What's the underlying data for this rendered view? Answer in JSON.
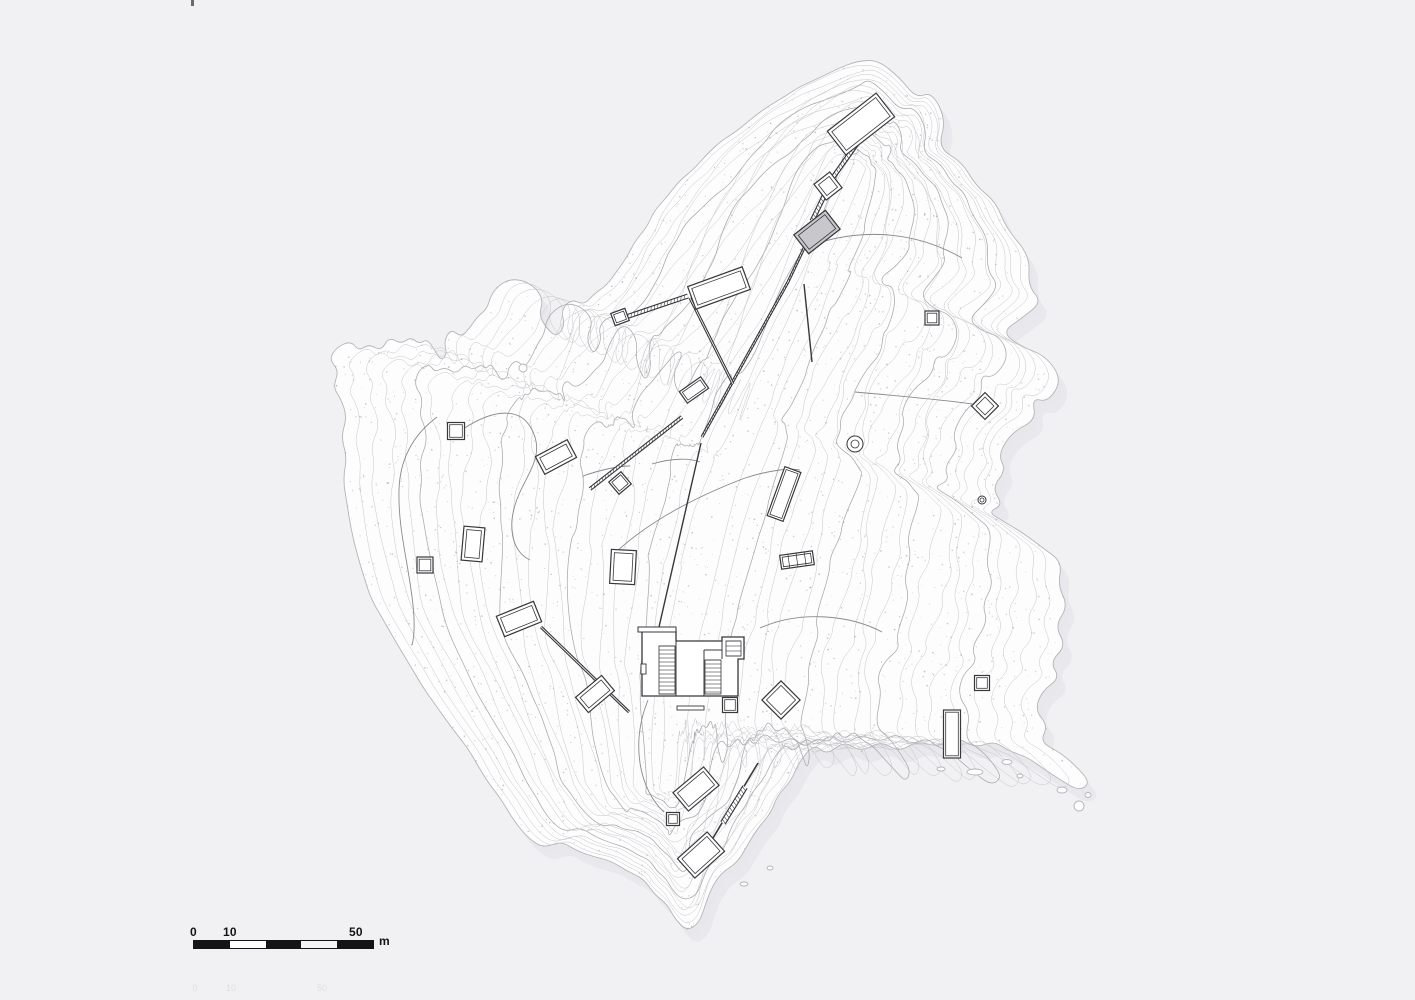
{
  "scale_bar": {
    "labels": [
      "0",
      "10",
      "50"
    ],
    "unit": "m",
    "segment_colors": [
      "#141414",
      "#ffffff",
      "#141414",
      "#f4f4f5",
      "#141414"
    ]
  },
  "ghost_labels": [
    {
      "text": "0",
      "x": 195,
      "y": 991
    },
    {
      "text": "10",
      "x": 231,
      "y": 991
    },
    {
      "text": "50",
      "x": 322,
      "y": 991
    }
  ],
  "top_mark": {
    "x": 191,
    "y": 0,
    "w": 3,
    "h": 6
  },
  "colors": {
    "background": "#f1f1f4",
    "island_fill": "#fdfdfe",
    "island_edge": "#b5b5b9",
    "shadow": "#e7e7eb",
    "contour": "#c6c6ca",
    "contour_index": "#a9a9ad",
    "stipple": "#98989c",
    "path": "#8a8a8e",
    "structure": "#38383c"
  },
  "island": {
    "contour_count": 22,
    "outline": [
      [
        878,
        60
      ],
      [
        900,
        78
      ],
      [
        916,
        98
      ],
      [
        932,
        92
      ],
      [
        946,
        120
      ],
      [
        938,
        148
      ],
      [
        962,
        162
      ],
      [
        976,
        186
      ],
      [
        996,
        202
      ],
      [
        1006,
        228
      ],
      [
        1030,
        256
      ],
      [
        1028,
        286
      ],
      [
        1042,
        302
      ],
      [
        1022,
        318
      ],
      [
        1002,
        332
      ],
      [
        1020,
        346
      ],
      [
        1046,
        356
      ],
      [
        1062,
        380
      ],
      [
        1048,
        402
      ],
      [
        1032,
        398
      ],
      [
        1036,
        420
      ],
      [
        1012,
        432
      ],
      [
        998,
        455
      ],
      [
        1006,
        470
      ],
      [
        992,
        488
      ],
      [
        1003,
        505
      ],
      [
        988,
        512
      ],
      [
        1003,
        521
      ],
      [
        1023,
        533
      ],
      [
        1043,
        548
      ],
      [
        1062,
        562
      ],
      [
        1058,
        586
      ],
      [
        1068,
        606
      ],
      [
        1055,
        626
      ],
      [
        1066,
        646
      ],
      [
        1050,
        662
      ],
      [
        1060,
        678
      ],
      [
        1042,
        691
      ],
      [
        1035,
        710
      ],
      [
        1048,
        726
      ],
      [
        1040,
        742
      ],
      [
        1061,
        753
      ],
      [
        1079,
        769
      ],
      [
        1090,
        783
      ],
      [
        1079,
        791
      ],
      [
        1059,
        779
      ],
      [
        1044,
        769
      ],
      [
        1027,
        757
      ],
      [
        1009,
        751
      ],
      [
        994,
        741
      ],
      [
        975,
        748
      ],
      [
        957,
        737
      ],
      [
        939,
        747
      ],
      [
        917,
        741
      ],
      [
        899,
        752
      ],
      [
        881,
        741
      ],
      [
        861,
        752
      ],
      [
        844,
        741
      ],
      [
        827,
        755
      ],
      [
        814,
        744
      ],
      [
        799,
        762
      ],
      [
        791,
        781
      ],
      [
        777,
        796
      ],
      [
        771,
        813
      ],
      [
        757,
        829
      ],
      [
        747,
        846
      ],
      [
        737,
        863
      ],
      [
        721,
        873
      ],
      [
        711,
        889
      ],
      [
        705,
        906
      ],
      [
        699,
        923
      ],
      [
        687,
        931
      ],
      [
        675,
        919
      ],
      [
        667,
        904
      ],
      [
        654,
        894
      ],
      [
        644,
        879
      ],
      [
        627,
        871
      ],
      [
        611,
        861
      ],
      [
        595,
        857
      ],
      [
        577,
        851
      ],
      [
        561,
        841
      ],
      [
        544,
        848
      ],
      [
        529,
        839
      ],
      [
        514,
        821
      ],
      [
        501,
        799
      ],
      [
        487,
        781
      ],
      [
        477,
        764
      ],
      [
        467,
        747
      ],
      [
        451,
        727
      ],
      [
        437,
        707
      ],
      [
        424,
        689
      ],
      [
        411,
        667
      ],
      [
        397,
        644
      ],
      [
        384,
        621
      ],
      [
        371,
        599
      ],
      [
        364,
        577
      ],
      [
        357,
        554
      ],
      [
        351,
        529
      ],
      [
        347,
        504
      ],
      [
        343,
        479
      ],
      [
        347,
        457
      ],
      [
        341,
        437
      ],
      [
        347,
        417
      ],
      [
        341,
        399
      ],
      [
        333,
        387
      ],
      [
        339,
        371
      ],
      [
        329,
        359
      ],
      [
        337,
        347
      ],
      [
        351,
        341
      ],
      [
        359,
        351
      ],
      [
        369,
        344
      ],
      [
        381,
        351
      ],
      [
        389,
        337
      ],
      [
        401,
        344
      ],
      [
        411,
        337
      ],
      [
        419,
        344
      ],
      [
        427,
        339
      ],
      [
        434,
        349
      ],
      [
        441,
        361
      ],
      [
        447,
        354
      ],
      [
        444,
        341
      ],
      [
        451,
        329
      ],
      [
        461,
        337
      ],
      [
        469,
        329
      ],
      [
        477,
        317
      ],
      [
        487,
        309
      ],
      [
        491,
        295
      ],
      [
        499,
        285
      ],
      [
        511,
        279
      ],
      [
        525,
        281
      ],
      [
        537,
        289
      ],
      [
        543,
        301
      ],
      [
        539,
        315
      ],
      [
        547,
        329
      ],
      [
        557,
        337
      ],
      [
        565,
        325
      ],
      [
        561,
        311
      ],
      [
        571,
        299
      ],
      [
        584,
        305
      ],
      [
        594,
        294
      ],
      [
        607,
        285
      ],
      [
        617,
        271
      ],
      [
        627,
        257
      ],
      [
        635,
        241
      ],
      [
        647,
        227
      ],
      [
        654,
        211
      ],
      [
        667,
        197
      ],
      [
        679,
        181
      ],
      [
        694,
        169
      ],
      [
        707,
        154
      ],
      [
        721,
        141
      ],
      [
        737,
        131
      ],
      [
        751,
        119
      ],
      [
        767,
        107
      ],
      [
        784,
        97
      ],
      [
        799,
        87
      ],
      [
        817,
        79
      ],
      [
        837,
        69
      ],
      [
        857,
        61
      ]
    ],
    "spine": [
      [
        858,
        165
      ],
      [
        826,
        245
      ],
      [
        782,
        345
      ],
      [
        730,
        460
      ],
      [
        696,
        570
      ],
      [
        676,
        680
      ],
      [
        668,
        790
      ]
    ],
    "islets": [
      {
        "name": "islet-ring",
        "cx": 523,
        "cy": 368,
        "rx": 4,
        "ry": 4
      },
      {
        "name": "islet",
        "cx": 975,
        "cy": 772,
        "rx": 8,
        "ry": 3
      },
      {
        "name": "islet",
        "cx": 1007,
        "cy": 762,
        "rx": 5,
        "ry": 2.5
      },
      {
        "name": "islet",
        "cx": 941,
        "cy": 769,
        "rx": 4,
        "ry": 2
      },
      {
        "name": "islet",
        "cx": 1020,
        "cy": 776,
        "rx": 3,
        "ry": 2
      },
      {
        "name": "islet",
        "cx": 1062,
        "cy": 790,
        "rx": 5,
        "ry": 3
      },
      {
        "name": "islet",
        "cx": 1079,
        "cy": 806,
        "rx": 5,
        "ry": 5
      },
      {
        "name": "islet",
        "cx": 1088,
        "cy": 795,
        "rx": 3,
        "ry": 2.5
      },
      {
        "name": "islet",
        "cx": 744,
        "cy": 884,
        "rx": 4,
        "ry": 2
      },
      {
        "name": "islet",
        "cx": 770,
        "cy": 868,
        "rx": 3,
        "ry": 2
      }
    ]
  },
  "structures": {
    "rects": [
      {
        "name": "north-jetty-head",
        "cx": 861,
        "cy": 124,
        "w": 62,
        "h": 30,
        "rot": -38
      },
      {
        "name": "north-wall-square",
        "cx": 828,
        "cy": 186,
        "w": 20,
        "h": 20,
        "rot": -38
      },
      {
        "name": "gray-roof-structure",
        "cx": 817,
        "cy": 232,
        "w": 40,
        "h": 24,
        "rot": -38,
        "fill": "#c8c8cc"
      },
      {
        "name": "upper-hall",
        "cx": 719,
        "cy": 288,
        "w": 58,
        "h": 24,
        "rot": -20
      },
      {
        "name": "l-wall-head",
        "cx": 620,
        "cy": 317,
        "w": 15,
        "h": 13,
        "rot": -20
      },
      {
        "name": "small-rect-a",
        "cx": 694,
        "cy": 390,
        "w": 26,
        "h": 14,
        "rot": -35
      },
      {
        "name": "rect-b",
        "cx": 556,
        "cy": 457,
        "w": 36,
        "h": 20,
        "rot": -28
      },
      {
        "name": "square-a",
        "cx": 456,
        "cy": 431,
        "w": 17,
        "h": 17,
        "rot": 0
      },
      {
        "name": "square-b",
        "cx": 425,
        "cy": 565,
        "w": 16,
        "h": 16,
        "rot": 0
      },
      {
        "name": "rect-c",
        "cx": 473,
        "cy": 544,
        "w": 21,
        "h": 34,
        "rot": 5
      },
      {
        "name": "rect-d",
        "cx": 519,
        "cy": 619,
        "w": 40,
        "h": 22,
        "rot": -22
      },
      {
        "name": "rect-e",
        "cx": 595,
        "cy": 694,
        "w": 34,
        "h": 20,
        "rot": -40
      },
      {
        "name": "rect-f",
        "cx": 623,
        "cy": 567,
        "w": 25,
        "h": 34,
        "rot": 3
      },
      {
        "name": "wall-node-square",
        "cx": 620,
        "cy": 483,
        "w": 16,
        "h": 16,
        "rot": -40
      },
      {
        "name": "rect-g",
        "cx": 696,
        "cy": 789,
        "w": 40,
        "h": 24,
        "rot": -40
      },
      {
        "name": "small-square-c",
        "cx": 673,
        "cy": 819,
        "w": 13,
        "h": 13,
        "rot": 0
      },
      {
        "name": "south-jetty-head",
        "cx": 701,
        "cy": 855,
        "w": 40,
        "h": 26,
        "rot": -42
      },
      {
        "name": "square-d",
        "cx": 730,
        "cy": 705,
        "w": 15,
        "h": 15,
        "rot": 0
      },
      {
        "name": "diamond-b",
        "cx": 781,
        "cy": 700,
        "w": 27,
        "h": 27,
        "rot": 45
      },
      {
        "name": "narrow-rect",
        "cx": 784,
        "cy": 494,
        "w": 17,
        "h": 52,
        "rot": 20
      },
      {
        "name": "tick-structure",
        "cx": 797,
        "cy": 560,
        "w": 33,
        "h": 14,
        "rot": -8,
        "ticks": 3
      },
      {
        "name": "square-e",
        "cx": 932,
        "cy": 318,
        "w": 14,
        "h": 14,
        "rot": 0
      },
      {
        "name": "diamond-a",
        "cx": 985,
        "cy": 406,
        "w": 19,
        "h": 19,
        "rot": 45
      },
      {
        "name": "square-f",
        "cx": 982,
        "cy": 683,
        "w": 15,
        "h": 15,
        "rot": 0
      },
      {
        "name": "rect-i",
        "cx": 952,
        "cy": 734,
        "w": 17,
        "h": 48,
        "rot": 0
      }
    ],
    "circles": [
      {
        "name": "well-circle",
        "cx": 855,
        "cy": 444,
        "r": 8,
        "r2": 4
      },
      {
        "name": "small-circle",
        "cx": 982,
        "cy": 500,
        "r": 4,
        "r2": 2
      }
    ],
    "walls": [
      {
        "name": "north-jetty-wall",
        "pts": [
          [
            861,
            138
          ],
          [
            829,
            183
          ]
        ],
        "w": 5,
        "double": true,
        "hatch": true
      },
      {
        "name": "north-wall-upper",
        "pts": [
          [
            826,
            192
          ],
          [
            812,
            221
          ]
        ],
        "w": 5,
        "double": true,
        "hatch": true
      },
      {
        "name": "north-wall-long",
        "pts": [
          [
            805,
            246
          ],
          [
            788,
            282
          ],
          [
            702,
            437
          ]
        ],
        "w": 3,
        "double": true,
        "hatch": true
      },
      {
        "name": "north-wall-lower",
        "pts": [
          [
            701,
            443
          ],
          [
            659,
            627
          ]
        ],
        "w": 1.4
      },
      {
        "name": "l-wall-top",
        "pts": [
          [
            626,
            317
          ],
          [
            688,
            296
          ]
        ],
        "w": 5,
        "double": true,
        "hatch": true
      },
      {
        "name": "l-wall-side",
        "pts": [
          [
            690,
            298
          ],
          [
            733,
            384
          ]
        ],
        "w": 3,
        "double": true
      },
      {
        "name": "spur-line",
        "pts": [
          [
            804,
            284
          ],
          [
            812,
            362
          ]
        ],
        "w": 1.4
      },
      {
        "name": "central-terrace-wall",
        "pts": [
          [
            590,
            489
          ],
          [
            682,
            417
          ]
        ],
        "w": 4,
        "double": true,
        "hatch": true
      },
      {
        "name": "sw-terrace-wall",
        "pts": [
          [
            541,
            627
          ],
          [
            629,
            712
          ]
        ],
        "w": 3,
        "double": true
      },
      {
        "name": "south-jetty-wall",
        "pts": [
          [
            758,
            763
          ],
          [
            707,
            848
          ]
        ],
        "w": 1.6
      },
      {
        "name": "south-jetty-thick",
        "pts": [
          [
            745,
            787
          ],
          [
            723,
            823
          ]
        ],
        "w": 6,
        "double": true,
        "hatch": true
      }
    ],
    "paths": [
      {
        "name": "trail-west",
        "d": "M437,417 C417,432 400,455 399,490 C398,530 408,560 413,605 C415,625 414,638 412,645"
      },
      {
        "name": "trail-west-loop",
        "d": "M463,429 C495,408 520,408 531,428 C545,452 530,470 520,492 C505,525 512,552 530,560"
      },
      {
        "name": "trail-mid-a",
        "d": "M583,476 C600,470 618,466 630,466 M652,464 C672,458 690,458 700,462"
      },
      {
        "name": "trail-mid-b",
        "d": "M615,553 C650,520 700,495 745,478 C770,470 790,468 800,470"
      },
      {
        "name": "trail-ne",
        "d": "M800,250 C850,228 910,228 962,258"
      },
      {
        "name": "trail-to-diamond",
        "d": "M855,392 C900,396 945,400 972,404"
      },
      {
        "name": "trail-east-of-building",
        "d": "M760,628 C800,610 850,615 882,632"
      },
      {
        "name": "trail-south",
        "d": "M648,700 C630,745 640,790 664,812"
      }
    ],
    "building": {
      "name": "main-building-complex",
      "outline": "M642,631 L676,631 L676,641 L722,641 L722,637 L744,637 L744,659 L738,659 L738,696 L642,696 Z",
      "inner_lines": [
        [
          676,
          641,
          676,
          696
        ],
        [
          704,
          650,
          704,
          696
        ],
        [
          704,
          650,
          722,
          650
        ],
        [
          722,
          641,
          722,
          659
        ],
        [
          738,
          659,
          744,
          659
        ]
      ],
      "hatch_blocks": [
        {
          "x": 659,
          "y": 646,
          "w": 16,
          "h": 48,
          "step": 4
        },
        {
          "x": 705,
          "y": 660,
          "w": 16,
          "h": 34,
          "step": 4
        },
        {
          "x": 726,
          "y": 641,
          "w": 15,
          "h": 15,
          "step": 5
        }
      ],
      "top_bar": {
        "x": 638,
        "y": 627,
        "w": 38,
        "h": 5
      },
      "bench": {
        "x": 677,
        "y": 706,
        "w": 27,
        "h": 4
      },
      "door": {
        "x": 641,
        "y": 664,
        "w": 5,
        "h": 10
      }
    }
  }
}
